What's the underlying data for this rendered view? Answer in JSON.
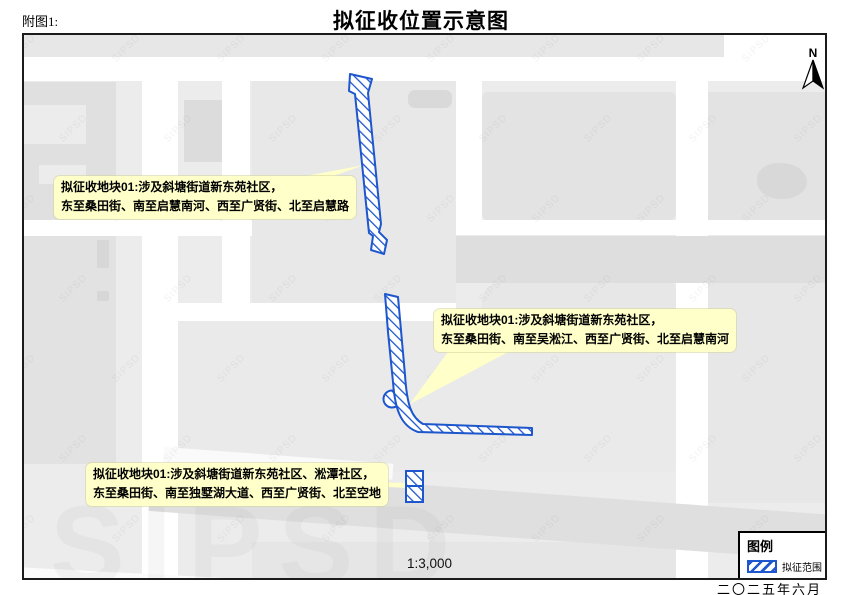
{
  "page": {
    "figure_label": "附图1:",
    "title": "拟征收位置示意图",
    "date": "二〇二五年六月"
  },
  "map": {
    "scale_text": "1:3,000",
    "north_label": "N",
    "watermark": "SIPSD",
    "callouts": [
      {
        "line1": "拟征收地块01:涉及斜塘街道新东苑社区，",
        "line2": "东至桑田街、南至启慧南河、西至广贤街、北至启慧路"
      },
      {
        "line1": "拟征收地块01:涉及斜塘街道新东苑社区，",
        "line2": "东至桑田街、南至吴淞江、西至广贤街、北至启慧南河"
      },
      {
        "line1": "拟征收地块01:涉及斜塘街道新东苑社区、淞潭社区，",
        "line2": "东至桑田街、南至独墅湖大道、西至广贤街、北至空地"
      }
    ],
    "colors": {
      "hatch_blue": "#1d56cd",
      "callout_yellow": "#ffffc9",
      "block_gray": "#e3e3e3",
      "road_white": "#ffffff"
    }
  },
  "legend": {
    "title": "图例",
    "items": [
      {
        "label": "拟征范围",
        "symbol": "blue-diagonal-hatch"
      }
    ]
  }
}
